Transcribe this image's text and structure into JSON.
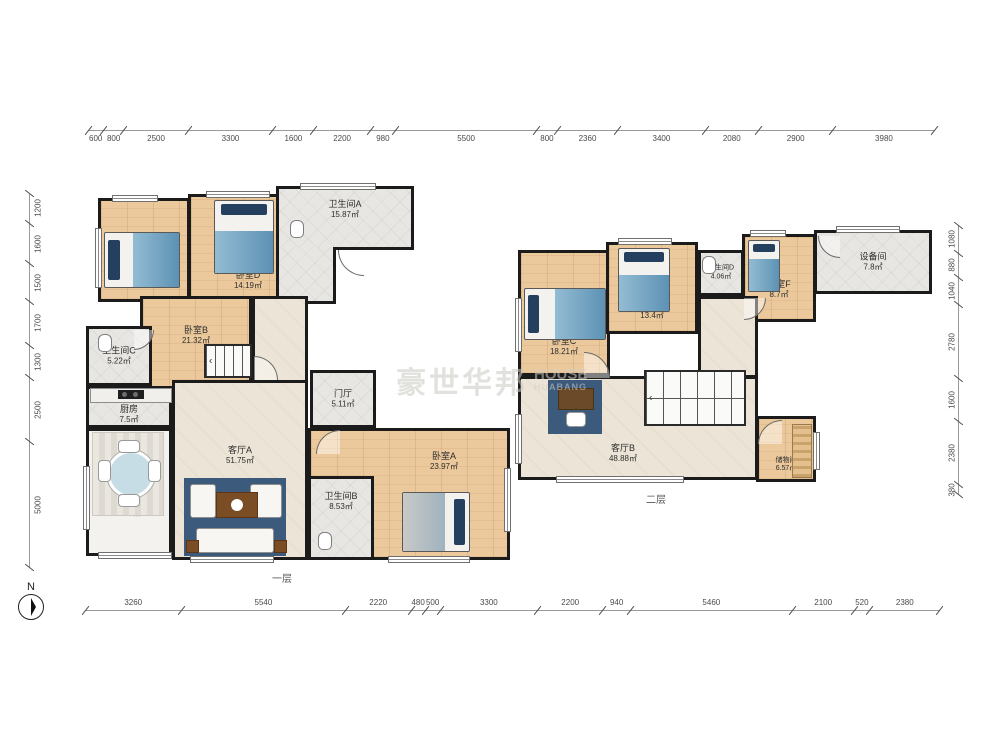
{
  "compass": {
    "label": "N"
  },
  "watermark": {
    "cn": "豪世华邦",
    "en_top": "HOUSE",
    "en_bottom": "HUABANG"
  },
  "glyphs": {
    "stair_arrow": "‹"
  },
  "floors": {
    "floor1": {
      "label": "一层",
      "rooms": [
        {
          "name": "卧室D",
          "area": "14.19㎡"
        },
        {
          "name": "卫生间A",
          "area": "15.87㎡"
        },
        {
          "name": "卧室B",
          "area": "21.32㎡"
        },
        {
          "name": "卫生间C",
          "area": "5.22㎡"
        },
        {
          "name": "厨房",
          "area": "7.5㎡"
        },
        {
          "name": "餐厅",
          "area": "16.3㎡"
        },
        {
          "name": "客厅A",
          "area": "51.75㎡"
        },
        {
          "name": "门厅",
          "area": "5.11㎡"
        },
        {
          "name": "卫生间B",
          "area": "8.53㎡"
        },
        {
          "name": "卧室A",
          "area": "23.97㎡"
        }
      ]
    },
    "floor2": {
      "label": "二层",
      "rooms": [
        {
          "name": "卧室C",
          "area": "18.21㎡"
        },
        {
          "name": "卧室E",
          "area": "13.4㎡"
        },
        {
          "name": "卫生间D",
          "area": "4.06㎡"
        },
        {
          "name": "卧室F",
          "area": "8.7㎡"
        },
        {
          "name": "设备间",
          "area": "7.8㎡"
        },
        {
          "name": "客厅B",
          "area": "48.88㎡"
        },
        {
          "name": "储物间",
          "area": "6.57㎡"
        }
      ]
    }
  },
  "dims": {
    "top": [
      "600",
      "800",
      "2500",
      "3300",
      "1600",
      "2200",
      "980",
      "5500",
      "800",
      "2360",
      "3400",
      "2080",
      "2900",
      "3980"
    ],
    "bottom": [
      "3260",
      "5540",
      "2220",
      "480",
      "500",
      "3300",
      "2200",
      "940",
      "5460",
      "2100",
      "520",
      "2380"
    ],
    "left": [
      "1200",
      "1600",
      "1500",
      "1700",
      "1300",
      "2500",
      "5000"
    ],
    "right": [
      "1080",
      "880",
      "1040",
      "2780",
      "1600",
      "2380",
      "380"
    ]
  }
}
